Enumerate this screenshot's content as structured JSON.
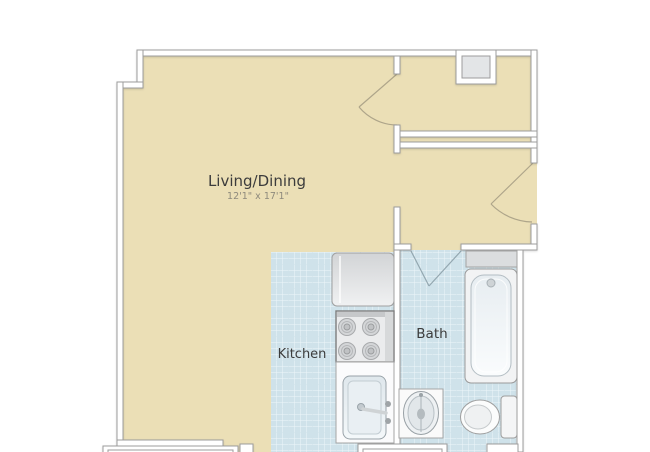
{
  "plan": {
    "title": "Studio floor plan",
    "rooms": {
      "living": {
        "label": "Living/Dining",
        "dimensions": "12'1\" x 17'1\""
      },
      "kitchen": {
        "label": "Kitchen"
      },
      "bath": {
        "label": "Bath"
      }
    },
    "fixtures": [
      "refrigerator",
      "stove",
      "kitchen-sink",
      "bathtub",
      "toilet",
      "pedestal-sink",
      "utility-shaft"
    ],
    "doors": [
      "closet-door",
      "entry-door",
      "bath-door"
    ],
    "colors": {
      "floor_beige": "#ebdfb6",
      "tile_base": "#cfe2ea",
      "tile_grid_light": "#eef6f9",
      "tile_grid_dark": "#b6d2de",
      "wall_fill": "#ffffff",
      "wall_stroke": "#9c9c9c",
      "label_text": "#3c3c3c",
      "dimension_text": "#8e8a7c",
      "fixture_gray": "#e3e5e7"
    }
  }
}
